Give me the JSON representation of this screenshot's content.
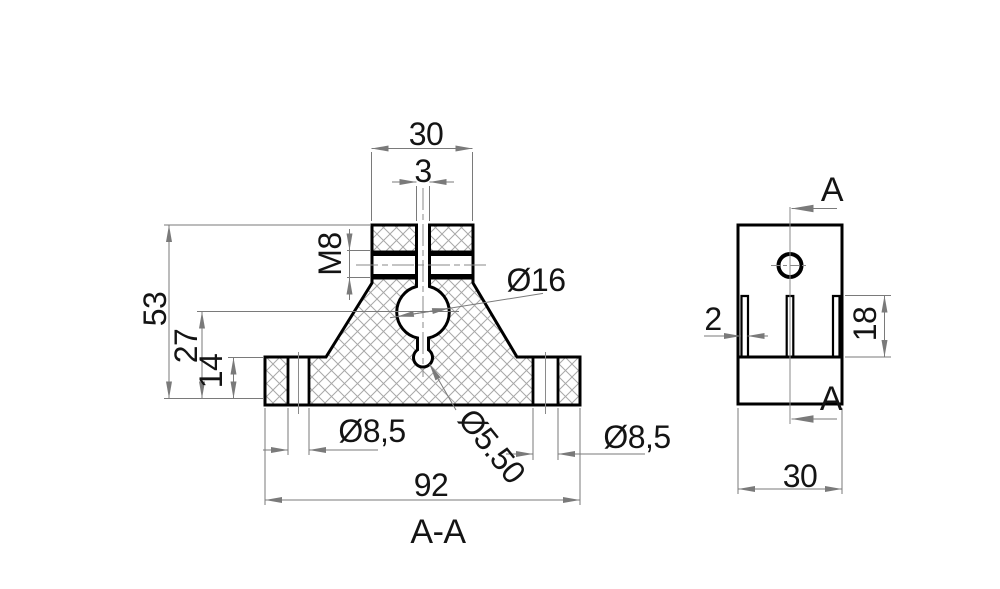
{
  "colors": {
    "outline": "#000000",
    "dimension": "#7a7a7a",
    "hatch": "#a8a8a8",
    "text": "#141414",
    "background": "#ffffff"
  },
  "section_view": {
    "dims": {
      "top_width": "30",
      "slot_width": "3",
      "thread": "M8",
      "bore_diameter": "Ø16",
      "overall_height": "53",
      "bore_center_height": "27",
      "flange_thickness": "14",
      "left_hole_diameter": "Ø8,5",
      "center_hole_diameter": "Ø5.50",
      "right_hole_diameter": "Ø8,5",
      "base_width": "92"
    },
    "caption": "A-A"
  },
  "side_view": {
    "dims": {
      "slot_width": "2",
      "slot_depth": "18",
      "body_width": "30"
    },
    "section_marker_top": "A",
    "section_marker_bottom": "A"
  }
}
